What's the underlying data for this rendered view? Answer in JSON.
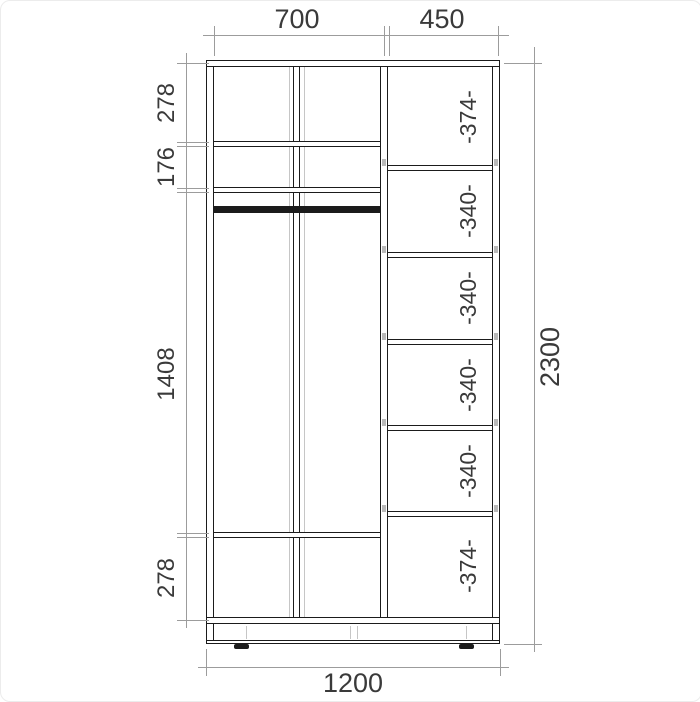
{
  "diagram": {
    "title": "wardrobe cross-section dimension drawing",
    "top_dims": [
      "700",
      "450"
    ],
    "left_dims": [
      "278",
      "176",
      "1408",
      "278"
    ],
    "overall_height": "2300",
    "overall_width": "1200",
    "right_compartments": [
      "-374-",
      "-340-",
      "-340-",
      "-340-",
      "-340-",
      "-374-"
    ],
    "colors": {
      "structure_line": "#1b1b1b",
      "dimension_line": "#9c9c9c",
      "text": "#3a3a3a",
      "background": "#ffffff"
    }
  }
}
